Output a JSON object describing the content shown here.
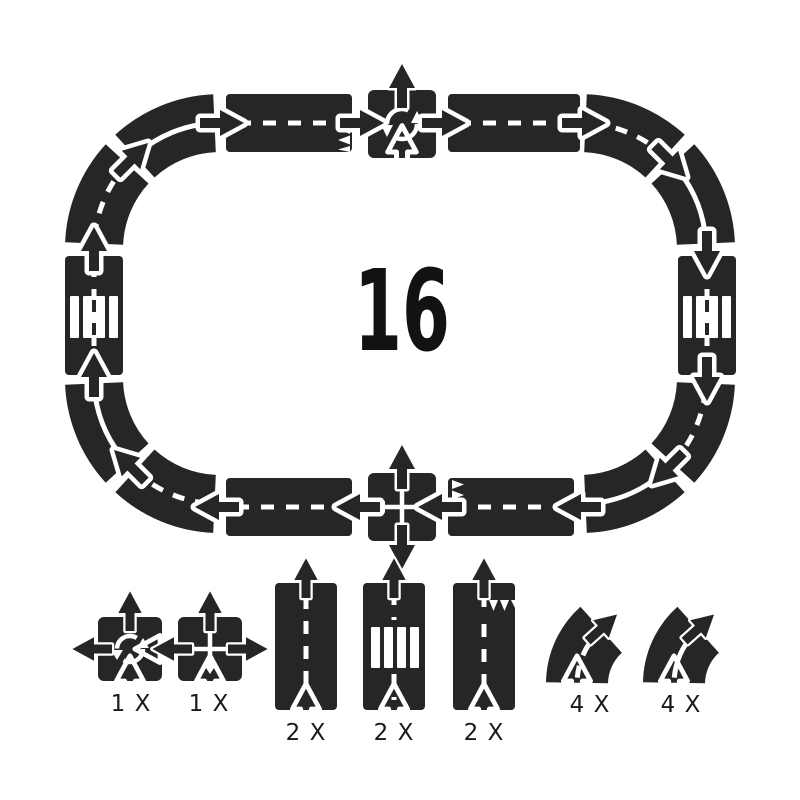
{
  "title": "toy road track set contents",
  "center_count": "16",
  "colors": {
    "piece": "#262626",
    "marking": "#ffffff",
    "background": "#ffffff",
    "text": "#1a1a1a"
  },
  "track": {
    "shape": "oval",
    "pieces_total": 16,
    "pieces_clockwise_from_left": [
      "curve-solid",
      "crosswalk",
      "curve-dashed",
      "curve-solid",
      "ramp-straight",
      "roundabout",
      "straight",
      "curve-dashed",
      "curve-solid",
      "crosswalk",
      "curve-dashed",
      "curve-solid",
      "ramp-straight",
      "intersection",
      "straight",
      "curve-dashed"
    ]
  },
  "legend": {
    "items": [
      {
        "piece": "roundabout",
        "count": "1 X"
      },
      {
        "piece": "intersection",
        "count": "1 X"
      },
      {
        "piece": "straight",
        "count": "2 X"
      },
      {
        "piece": "crosswalk",
        "count": "2 X"
      },
      {
        "piece": "ramp-straight",
        "count": "2 X"
      },
      {
        "piece": "curve-dashed-line",
        "count": "4 X"
      },
      {
        "piece": "curve-solid-line",
        "count": "4 X"
      }
    ]
  }
}
